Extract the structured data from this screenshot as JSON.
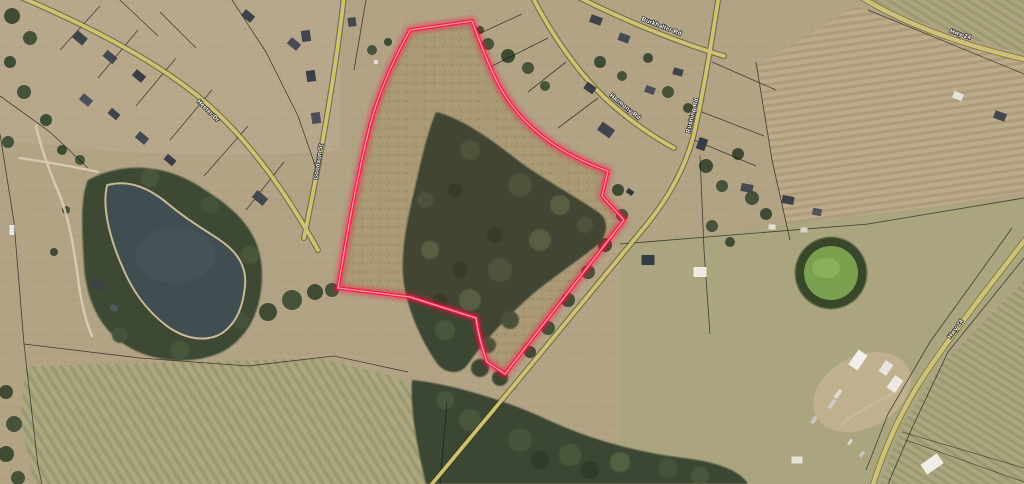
{
  "map": {
    "road_labels": {
      "road_a": "Hester Dr",
      "road_g": "Goodson St",
      "road_b": "Burkhalter Rd",
      "road_d": "Harmony Rd",
      "road_c": "Rushing Rd",
      "hwy_ne": "Hwy 24",
      "road_se": "Hwy 24"
    },
    "boundary": {
      "color": "#ff1744",
      "glow_color": "#ff0f3c",
      "core_color": "#ffa7bd"
    },
    "colors": {
      "field_tan": "#b2a385",
      "scrub": "#a79d77",
      "tree_green": "#3a4730",
      "pond": "#404e52",
      "pond_rim": "#c9ba96",
      "road_yellow": "#ded23f",
      "road_surface": "#c9bc96",
      "parcel_line": "#161616",
      "green_circle": "#7aa150"
    }
  }
}
